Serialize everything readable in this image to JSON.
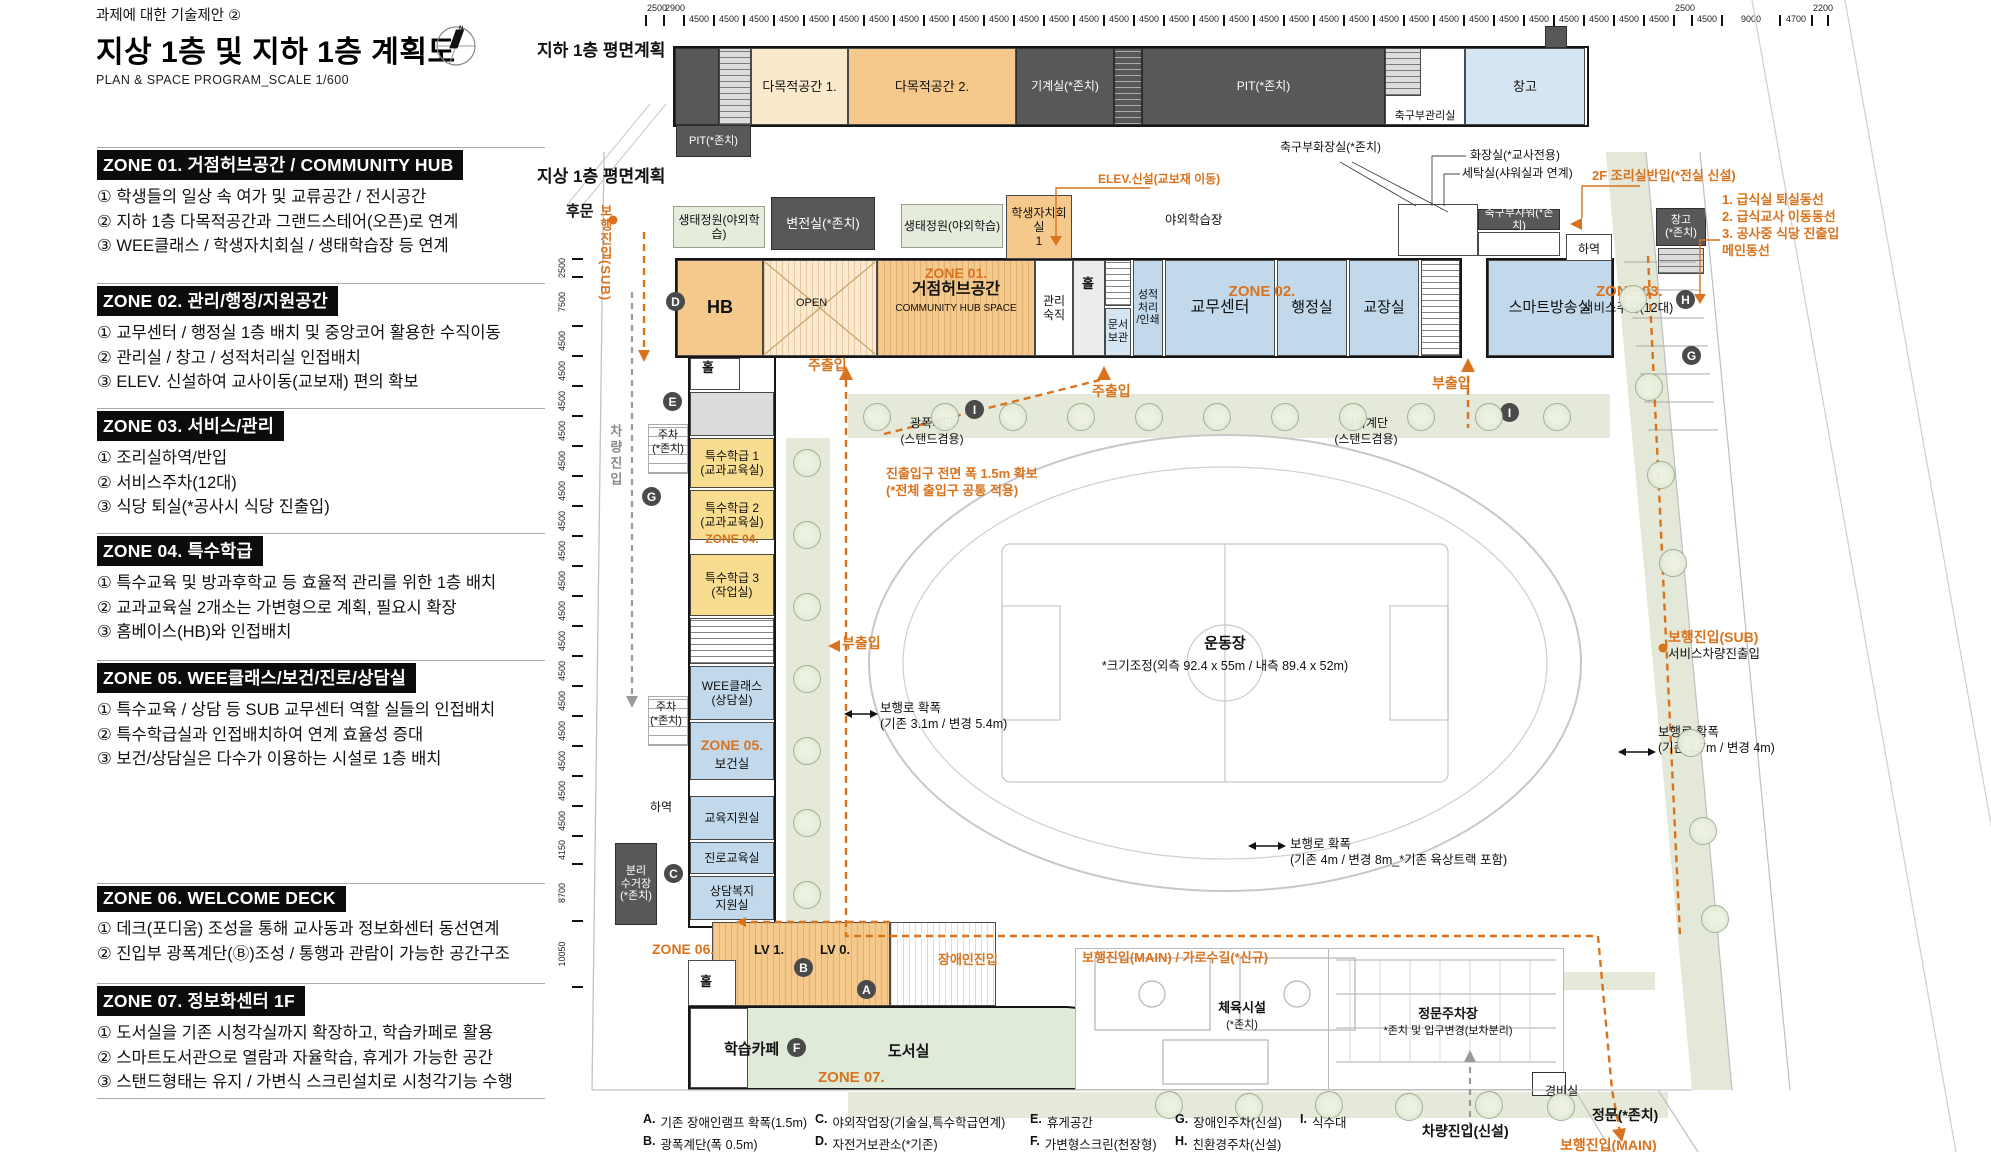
{
  "page": {
    "doc_note": "과제에 대한 기술제안 ②",
    "title": "지상 1층 및 지하 1층 계획도",
    "subtitle": "PLAN & SPACE PROGRAM_SCALE 1/600",
    "compass_letter": "N"
  },
  "colors": {
    "accent_orange": "#D9731E",
    "dark_room": "#585858",
    "room_blue": "#C2D9EB",
    "room_peach": "#F5C98B",
    "room_yellow": "#F8DC8F",
    "landscape": "#E4E9DA"
  },
  "sidebar": {
    "zones": [
      {
        "y": 147,
        "header": "ZONE 01. 거점허브공간 / COMMUNITY HUB",
        "items": [
          "① 학생들의 일상 속 여가 및 교류공간 / 전시공간",
          "② 지하 1층 다목적공간과 그랜드스테어(오픈)로 연계",
          "③ WEE클래스 / 학생자치회실 / 생태학습장 등 연계"
        ]
      },
      {
        "y": 283,
        "header": "ZONE 02. 관리/행정/지원공간",
        "items": [
          "① 교무센터 / 행정실 1층 배치 및 중앙코어 활용한 수직이동",
          "② 관리실 / 창고 / 성적처리실 인접배치",
          "③ ELEV. 신설하여 교사이동(교보재) 편의 확보"
        ]
      },
      {
        "y": 408,
        "header": "ZONE 03. 서비스/관리",
        "items": [
          "① 조리실하역/반입",
          "② 서비스주차(12대)",
          "③ 식당 퇴실(*공사시 식당 진출입)"
        ]
      },
      {
        "y": 533,
        "header": "ZONE 04. 특수학급",
        "items": [
          "① 특수교육 및 방과후학교 등 효율적 관리를 위한 1층 배치",
          "② 교과교육실 2개소는 가변형으로 계획, 필요시 확장",
          "③ 홈베이스(HB)와 인접배치"
        ]
      },
      {
        "y": 660,
        "header": "ZONE 05. WEE클래스/보건/진로/상담실",
        "items": [
          "① 특수교육 / 상담 등 SUB 교무센터 역할 실들의 인접배치",
          "② 특수학급실과 인접배치하여 연계 효율성 증대",
          "③ 보건/상담실은 다수가 이용하는 시설로 1층 배치"
        ]
      },
      {
        "y": 883,
        "header": "ZONE 06. WELCOME DECK",
        "items": [
          "① 데크(포디움) 조성을 통해 교사동과 정보화센터 동선연계",
          "② 진입부 광폭계단(Ⓑ)조성 / 통행과 관람이 가능한 공간구조"
        ]
      },
      {
        "y": 983,
        "header": "ZONE 07. 정보화센터 1F",
        "items": [
          "① 도서실을 기존 시청각실까지 확장하고, 학습카페로 활용",
          "② 스마트도서관으로 열람과 자율학습, 휴게가 가능한 공간",
          "③ 스탠드형태는 유지 / 가변식 스크린설치로 시청각기능 수행"
        ]
      }
    ]
  },
  "rulers": {
    "top": [
      {
        "l": "2500",
        "w": 16,
        "a": 1
      },
      {
        "l": "2900",
        "w": 18,
        "a": 1
      },
      {
        "l": "4500",
        "w": 28,
        "n": 33
      },
      {
        "l": "2500",
        "w": 16,
        "a": 1
      },
      {
        "l": "4500",
        "w": 28
      },
      {
        "l": "9000",
        "w": 56
      },
      {
        "l": "4700",
        "w": 30
      },
      {
        "l": "2200",
        "w": 14,
        "a": 1
      }
    ],
    "left": [
      {
        "l": "2500",
        "h": 16
      },
      {
        "l": "7500",
        "h": 47
      },
      {
        "l": "4500",
        "h": 28,
        "n": 17
      },
      {
        "l": "4150",
        "h": 26
      },
      {
        "l": "8700",
        "h": 55
      },
      {
        "l": "10050",
        "h": 64
      }
    ]
  },
  "basement": {
    "label": "지하 1층 평면계획",
    "rooms": [
      {
        "l": "",
        "x": 675,
        "y": 48,
        "w": 44,
        "h": 77,
        "c": "dark"
      },
      {
        "l": "",
        "x": 719,
        "y": 48,
        "w": 32,
        "h": 77,
        "c": "gray",
        "st": 1
      },
      {
        "l": "다목적공간 1.",
        "x": 751,
        "y": 48,
        "w": 97,
        "h": 77,
        "c": "lpeach",
        "fs": 13
      },
      {
        "l": "다목적공간 2.",
        "x": 848,
        "y": 48,
        "w": 168,
        "h": 77,
        "c": "peach",
        "fs": 13
      },
      {
        "l": "기계실(*존치)",
        "x": 1016,
        "y": 48,
        "w": 98,
        "h": 77,
        "c": "dark",
        "fs": 12
      },
      {
        "l": "",
        "x": 1114,
        "y": 48,
        "w": 28,
        "h": 77,
        "c": "dark",
        "st": 1
      },
      {
        "l": "PIT(*존치)",
        "x": 1142,
        "y": 48,
        "w": 243,
        "h": 77,
        "c": "dark",
        "fs": 12
      },
      {
        "l": "축구부관리실",
        "x": 1385,
        "y": 48,
        "w": 80,
        "h": 77,
        "c": "white",
        "fs": 11,
        "lb": 1
      },
      {
        "l": "",
        "x": 1385,
        "y": 48,
        "w": 36,
        "h": 48,
        "c": "gray",
        "st": 1
      },
      {
        "l": "창고",
        "x": 1465,
        "y": 48,
        "w": 120,
        "h": 77,
        "c": "lblue",
        "fs": 13
      },
      {
        "l": "",
        "x": 1545,
        "y": 26,
        "w": 22,
        "h": 22,
        "c": "dark"
      },
      {
        "l": "PIT(*존치)",
        "x": 676,
        "y": 125,
        "w": 75,
        "h": 32,
        "c": "dark",
        "fs": 11
      }
    ]
  },
  "ground": {
    "label": "지상 1층 평면계획",
    "rooms": [
      {
        "l": "생태정원(야외학습)",
        "x": 673,
        "y": 206,
        "w": 92,
        "h": 42,
        "c": "green",
        "fs": 12
      },
      {
        "l": "변전실(*존치)",
        "x": 771,
        "y": 197,
        "w": 104,
        "h": 53,
        "c": "dark",
        "fs": 13
      },
      {
        "l": "생태정원(야외학습)",
        "x": 901,
        "y": 204,
        "w": 102,
        "h": 44,
        "c": "green",
        "fs": 12
      },
      {
        "l": "학생자치회실\n1",
        "x": 1006,
        "y": 195,
        "w": 66,
        "h": 64,
        "c": "peach",
        "fs": 12
      },
      {
        "l": "",
        "x": 1398,
        "y": 204,
        "w": 80,
        "h": 52,
        "c": "white"
      },
      {
        "l": "축구부샤워(*존치)",
        "x": 1478,
        "y": 209,
        "w": 82,
        "h": 21,
        "c": "dark",
        "fs": 11
      },
      {
        "l": "",
        "x": 1478,
        "y": 232,
        "w": 82,
        "h": 24,
        "c": "white"
      },
      {
        "l": "하역",
        "x": 1566,
        "y": 234,
        "w": 46,
        "h": 30,
        "c": "white",
        "fs": 12
      },
      {
        "l": "창고\n(*존치)",
        "x": 1656,
        "y": 208,
        "w": 50,
        "h": 38,
        "c": "dark",
        "fs": 11
      },
      {
        "l": "",
        "x": 1658,
        "y": 248,
        "w": 46,
        "h": 26,
        "c": "gray",
        "st": 1
      },
      {
        "l": "HB",
        "x": 677,
        "y": 260,
        "w": 86,
        "h": 96,
        "c": "peach",
        "fs": 18,
        "b": 1
      },
      {
        "l": "",
        "x": 763,
        "y": 260,
        "w": 114,
        "h": 96,
        "c": "lpeach",
        "hv": 1
      },
      {
        "l": "",
        "x": 877,
        "y": 260,
        "w": 158,
        "h": 96,
        "c": "peach",
        "hv": 1
      },
      {
        "l": "관리\n숙직",
        "x": 1035,
        "y": 260,
        "w": 38,
        "h": 96,
        "c": "white",
        "fs": 12
      },
      {
        "l": "",
        "x": 1073,
        "y": 260,
        "w": 32,
        "h": 96,
        "c": "corr"
      },
      {
        "l": "",
        "x": 1105,
        "y": 260,
        "w": 26,
        "h": 46,
        "c": "white",
        "st": 1
      },
      {
        "l": "문서\n보관",
        "x": 1105,
        "y": 308,
        "w": 26,
        "h": 48,
        "c": "lblue",
        "fs": 11
      },
      {
        "l": "성적\n처리\n/인쇄",
        "x": 1133,
        "y": 260,
        "w": 30,
        "h": 96,
        "c": "blue",
        "fs": 11
      },
      {
        "l": "교무센터",
        "x": 1165,
        "y": 260,
        "w": 110,
        "h": 96,
        "c": "blue",
        "fs": 16
      },
      {
        "l": "행정실",
        "x": 1277,
        "y": 260,
        "w": 70,
        "h": 96,
        "c": "blue",
        "fs": 15
      },
      {
        "l": "교장실",
        "x": 1349,
        "y": 260,
        "w": 70,
        "h": 96,
        "c": "blue",
        "fs": 15
      },
      {
        "l": "",
        "x": 1421,
        "y": 260,
        "w": 39,
        "h": 96,
        "c": "white",
        "st": 1
      },
      {
        "l": "스마트방송실",
        "x": 1488,
        "y": 260,
        "w": 124,
        "h": 96,
        "c": "blue",
        "fs": 15
      },
      {
        "l": "",
        "x": 690,
        "y": 358,
        "w": 50,
        "h": 32,
        "c": "white"
      },
      {
        "l": "",
        "x": 690,
        "y": 392,
        "w": 84,
        "h": 44,
        "c": "gray"
      },
      {
        "l": "특수학급 1\n(교과교육실)",
        "x": 690,
        "y": 438,
        "w": 84,
        "h": 50,
        "c": "yellow",
        "fs": 12
      },
      {
        "l": "특수학급 2\n(교과교육실)",
        "x": 690,
        "y": 490,
        "w": 84,
        "h": 50,
        "c": "yellow",
        "fs": 12
      },
      {
        "l": "특수학급 3\n(작업실)",
        "x": 690,
        "y": 554,
        "w": 84,
        "h": 62,
        "c": "yellow",
        "fs": 12
      },
      {
        "l": "",
        "x": 690,
        "y": 618,
        "w": 84,
        "h": 46,
        "c": "white",
        "st": 1
      },
      {
        "l": "WEE클래스\n(상담실)",
        "x": 690,
        "y": 666,
        "w": 84,
        "h": 54,
        "c": "blue",
        "fs": 12
      },
      {
        "l": "",
        "x": 690,
        "y": 722,
        "w": 84,
        "h": 58,
        "c": "blue"
      },
      {
        "l": "교육지원실",
        "x": 690,
        "y": 796,
        "w": 84,
        "h": 44,
        "c": "blue",
        "fs": 12
      },
      {
        "l": "진로교육실",
        "x": 690,
        "y": 842,
        "w": 84,
        "h": 32,
        "c": "blue",
        "fs": 12
      },
      {
        "l": "상담복지\n지원실",
        "x": 690,
        "y": 876,
        "w": 84,
        "h": 44,
        "c": "blue",
        "fs": 12
      },
      {
        "l": "분리\n수거장\n(*존치)",
        "x": 615,
        "y": 843,
        "w": 42,
        "h": 82,
        "c": "dark",
        "fs": 11
      },
      {
        "l": "",
        "x": 648,
        "y": 424,
        "w": 40,
        "h": 50,
        "c": "white",
        "pk": 1
      },
      {
        "l": "",
        "x": 648,
        "y": 696,
        "w": 40,
        "h": 50,
        "c": "white",
        "pk": 1
      },
      {
        "l": "",
        "x": 712,
        "y": 922,
        "w": 178,
        "h": 84,
        "c": "peach",
        "hv": 1
      },
      {
        "l": "",
        "x": 890,
        "y": 922,
        "w": 106,
        "h": 84,
        "c": "white",
        "hv": 1
      },
      {
        "l": "",
        "x": 688,
        "y": 960,
        "w": 48,
        "h": 46,
        "c": "white"
      },
      {
        "l": "",
        "x": 690,
        "y": 1008,
        "w": 58,
        "h": 80,
        "c": "white"
      }
    ],
    "notes": [
      {
        "t": "지하 1층 평면계획",
        "x": 537,
        "y": 40,
        "k": "bb17"
      },
      {
        "t": "지상 1층 평면계획",
        "x": 537,
        "y": 166,
        "k": "bb17"
      },
      {
        "t": "후문",
        "x": 566,
        "y": 202,
        "k": "bb15"
      },
      {
        "t": "야외학습장",
        "x": 1165,
        "y": 212,
        "k": "b13"
      },
      {
        "t": "ELEV.신설(교보재 이동)",
        "x": 1098,
        "y": 172,
        "k": "on12"
      },
      {
        "t": "축구부화장실(*존치)",
        "x": 1280,
        "y": 140,
        "k": "b12"
      },
      {
        "t": "화장실(*교사전용)",
        "x": 1470,
        "y": 148,
        "k": "b12"
      },
      {
        "t": "세탁실(샤워실과 연계)",
        "x": 1462,
        "y": 166,
        "k": "b12"
      },
      {
        "t": "2F 조리실반입(*전실 신설)",
        "x": 1592,
        "y": 168,
        "k": "on13"
      },
      {
        "t": "1. 급식실 퇴실동선\n2. 급식교사 이동동선\n3. 공사중 식당 진출입\n    메인동선",
        "x": 1722,
        "y": 192,
        "k": "on13"
      },
      {
        "t": "주출입",
        "x": 808,
        "y": 356,
        "k": "o14"
      },
      {
        "t": "주출입",
        "x": 1092,
        "y": 382,
        "k": "o14"
      },
      {
        "t": "부출입",
        "x": 1432,
        "y": 374,
        "k": "o14"
      },
      {
        "t": "부출입",
        "x": 842,
        "y": 634,
        "k": "o14"
      },
      {
        "t": "광폭계단\n(스탠드겸용)",
        "x": 932,
        "y": 416,
        "k": "b12",
        "c": 1
      },
      {
        "t": "광폭계단\n(스탠드겸용)",
        "x": 1366,
        "y": 416,
        "k": "b12",
        "c": 1
      },
      {
        "t": "진출입구 전면 폭 1.5m 확보\n(*전체 출입구 공통 적용)",
        "x": 886,
        "y": 466,
        "k": "on13"
      },
      {
        "t": "운동장",
        "x": 1225,
        "y": 634,
        "k": "bb15",
        "c": 1
      },
      {
        "t": "*크기조정(외측 92.4 x 55m / 내측 89.4 x 52m)",
        "x": 1225,
        "y": 658,
        "k": "b13",
        "c": 1
      },
      {
        "t": "보행로 확폭\n(기존 3.1m / 변경 5.4m)",
        "x": 880,
        "y": 700,
        "k": "b13"
      },
      {
        "t": "보행로 확폭\n(기존 4m / 변경 8m_*기존 육상트랙 포함)",
        "x": 1290,
        "y": 836,
        "k": "b13"
      },
      {
        "t": "보행로 확폭\n(기존 2.7m / 변경 4m)",
        "x": 1658,
        "y": 724,
        "k": "b13"
      },
      {
        "t": "보행진입(SUB)",
        "x": 1668,
        "y": 628,
        "k": "o14"
      },
      {
        "t": "서비스차량진출입",
        "x": 1668,
        "y": 646,
        "k": "b13"
      },
      {
        "t": "보행진입(MAIN) / 가로수길(*신규)",
        "x": 1082,
        "y": 950,
        "k": "on13"
      },
      {
        "t": "장애인진입",
        "x": 938,
        "y": 952,
        "k": "on13"
      },
      {
        "t": "LV 1.",
        "x": 754,
        "y": 942,
        "k": "bb13"
      },
      {
        "t": "LV 0.",
        "x": 820,
        "y": 942,
        "k": "bb13"
      },
      {
        "t": "ZONE 03.",
        "x": 1596,
        "y": 282,
        "k": "o15"
      },
      {
        "t": "서비스주차(12대)",
        "x": 1582,
        "y": 300,
        "k": "b13"
      },
      {
        "t": "체육시설",
        "x": 1242,
        "y": 1000,
        "k": "bb13",
        "c": 1
      },
      {
        "t": "(*존치)",
        "x": 1242,
        "y": 1018,
        "k": "b11",
        "c": 1
      },
      {
        "t": "정문주차장",
        "x": 1448,
        "y": 1006,
        "k": "bb13",
        "c": 1
      },
      {
        "t": "*존치 및 입구변경(보차분리)",
        "x": 1448,
        "y": 1024,
        "k": "b11",
        "c": 1
      },
      {
        "t": "경비실",
        "x": 1545,
        "y": 1084,
        "k": "b12"
      },
      {
        "t": "정문(*존치)",
        "x": 1592,
        "y": 1106,
        "k": "bb14"
      },
      {
        "t": "차량진입(신설)",
        "x": 1422,
        "y": 1122,
        "k": "bb14"
      },
      {
        "t": "보행진입(MAIN)",
        "x": 1560,
        "y": 1136,
        "k": "o14"
      },
      {
        "t": "차량진입",
        "x": 606,
        "y": 424,
        "k": "vgray"
      },
      {
        "t": "보행진입(SUB)",
        "x": 596,
        "y": 204,
        "k": "vorange"
      },
      {
        "t": "ZONE 06.",
        "x": 652,
        "y": 940,
        "k": "o14"
      },
      {
        "t": "ZONE 07.",
        "x": 818,
        "y": 1068,
        "k": "o15"
      },
      {
        "t": "하역",
        "x": 650,
        "y": 800,
        "k": "b12"
      },
      {
        "t": "주차\n(*존치)",
        "x": 668,
        "y": 428,
        "k": "b11",
        "c": 1
      },
      {
        "t": "주차\n(*존치)",
        "x": 666,
        "y": 700,
        "k": "b11",
        "c": 1
      },
      {
        "t": "OPEN",
        "x": 796,
        "y": 296,
        "k": "b11"
      },
      {
        "t": "ZONE 01.",
        "x": 956,
        "y": 264,
        "k": "o14",
        "c": 1
      },
      {
        "t": "거점허브공간",
        "x": 956,
        "y": 280,
        "k": "bb16",
        "c": 1
      },
      {
        "t": "COMMUNITY HUB SPACE",
        "x": 956,
        "y": 302,
        "k": "b10",
        "c": 1
      },
      {
        "t": "ZONE 02.",
        "x": 1262,
        "y": 282,
        "k": "o15",
        "c": 1
      },
      {
        "t": "ZONE 04.",
        "x": 732,
        "y": 532,
        "k": "on12",
        "c": 1
      },
      {
        "t": "ZONE 05.",
        "x": 732,
        "y": 736,
        "k": "o14",
        "c": 1
      },
      {
        "t": "보건실",
        "x": 732,
        "y": 756,
        "k": "b13",
        "c": 1
      },
      {
        "t": "홀",
        "x": 1082,
        "y": 276,
        "k": "bb13"
      },
      {
        "t": "홀",
        "x": 702,
        "y": 360,
        "k": "bb13"
      },
      {
        "t": "홀",
        "x": 700,
        "y": 974,
        "k": "bb13"
      },
      {
        "t": "학습카페",
        "x": 724,
        "y": 1040,
        "k": "bb15"
      },
      {
        "t": "도서실",
        "x": 888,
        "y": 1042,
        "k": "bb15"
      }
    ],
    "markers": [
      [
        "D",
        676,
        302
      ],
      [
        "E",
        673,
        402
      ],
      [
        "G",
        652,
        497
      ],
      [
        "C",
        674,
        874
      ],
      [
        "B",
        804,
        968
      ],
      [
        "A",
        867,
        990
      ],
      [
        "F",
        797,
        1048
      ],
      [
        "I",
        975,
        410
      ],
      [
        "I",
        1510,
        413
      ],
      [
        "H",
        1686,
        300
      ],
      [
        "G",
        1692,
        356
      ]
    ],
    "trees": [
      [
        876,
        416
      ],
      [
        944,
        416
      ],
      [
        1012,
        416
      ],
      [
        1080,
        416
      ],
      [
        1148,
        416
      ],
      [
        1216,
        416
      ],
      [
        1284,
        416
      ],
      [
        1352,
        416
      ],
      [
        1420,
        416
      ],
      [
        1488,
        416
      ],
      [
        1556,
        416
      ],
      [
        806,
        462
      ],
      [
        806,
        534
      ],
      [
        806,
        606
      ],
      [
        806,
        678
      ],
      [
        806,
        750
      ],
      [
        806,
        822
      ],
      [
        806,
        894
      ],
      [
        1632,
        298
      ],
      [
        1648,
        386
      ],
      [
        1660,
        474
      ],
      [
        1672,
        562
      ],
      [
        1690,
        742
      ],
      [
        1702,
        830
      ],
      [
        1714,
        918
      ],
      [
        1168,
        1104
      ],
      [
        1248,
        1106
      ],
      [
        1328,
        1104
      ],
      [
        1408,
        1106
      ],
      [
        1488,
        1104
      ],
      [
        1560,
        1106
      ]
    ]
  },
  "legend": {
    "items": [
      {
        "key": "A.",
        "text": "기존 장애인램프 확폭(1.5m)",
        "x": 643,
        "y": 1112
      },
      {
        "key": "B.",
        "text": "광폭계단(폭 0.5m)",
        "x": 643,
        "y": 1134
      },
      {
        "key": "C.",
        "text": "야외작업장(기술실,특수학급연계)",
        "x": 815,
        "y": 1112
      },
      {
        "key": "D.",
        "text": "자전거보관소(*기존)",
        "x": 815,
        "y": 1134
      },
      {
        "key": "E.",
        "text": "휴게공간",
        "x": 1030,
        "y": 1112
      },
      {
        "key": "F.",
        "text": "가변형스크린(천장형)",
        "x": 1030,
        "y": 1134
      },
      {
        "key": "G.",
        "text": "장애인주차(신설)",
        "x": 1175,
        "y": 1112
      },
      {
        "key": "H.",
        "text": "친환경주차(신설)",
        "x": 1175,
        "y": 1134
      },
      {
        "key": "I.",
        "text": "식수대",
        "x": 1300,
        "y": 1112
      }
    ]
  }
}
